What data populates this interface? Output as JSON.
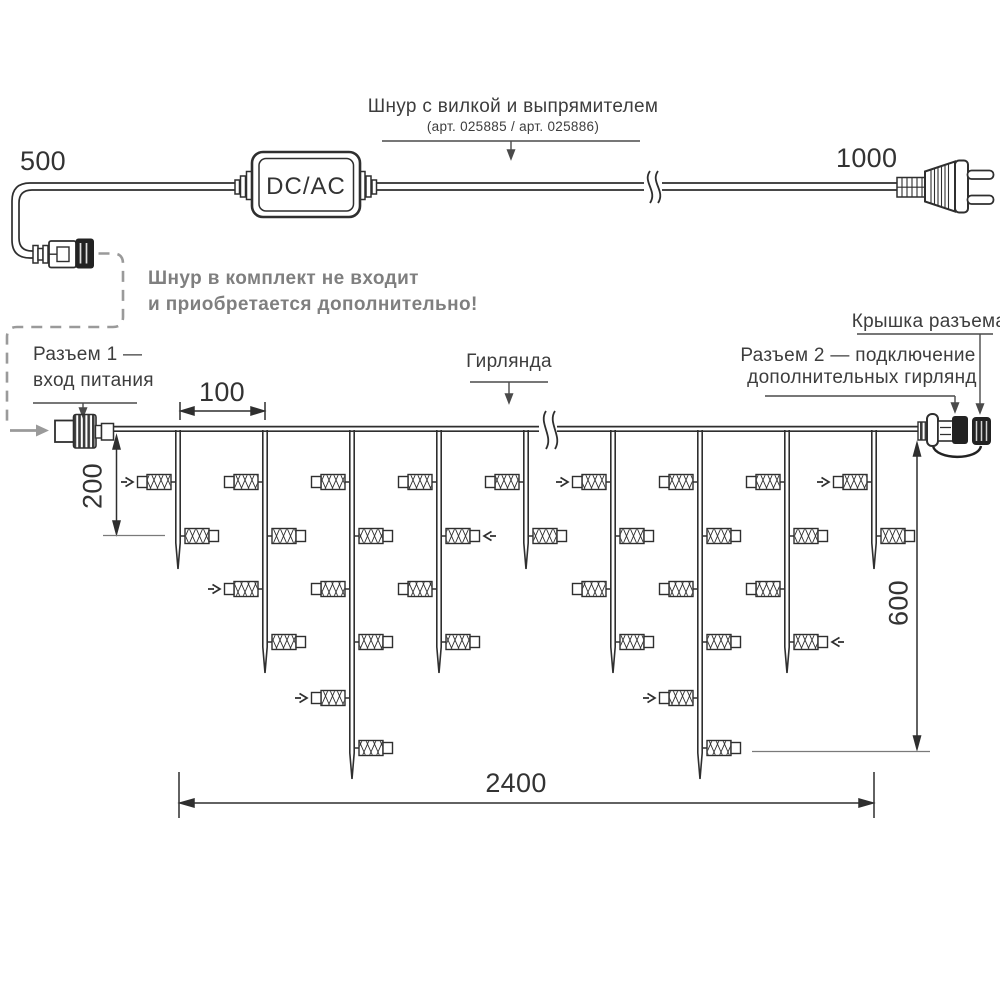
{
  "top_section": {
    "cord_left_length": "500",
    "cord_right_length": "1000",
    "converter_label": "DC/AC",
    "cord_title": "Шнур с вилкой и выпрямителем",
    "cord_subtitle": "(арт. 025885 / арт. 025886)",
    "note_line1": "Шнур в комплект не входит",
    "note_line2": "и приобретается дополнительно!"
  },
  "labels": {
    "connector1_line1": "Разъем 1 —",
    "connector1_line2": "вход питания",
    "garland": "Гирлянда",
    "connector2_line1": "Разъем 2 — подключение",
    "connector2_line2": "дополнительных гирлянд",
    "cap": "Крышка разъема"
  },
  "dimensions": {
    "drop_spacing": "100",
    "first_drop_length": "200",
    "max_drop_length": "600",
    "garland_width": "2400"
  },
  "colors": {
    "ink": "#2f2f2f",
    "leader": "#4a4a4a",
    "tick": "#7a7a7a",
    "dashed": "#9a9a9a",
    "black_part": "#222222",
    "note_gray": "#7f7f7f"
  },
  "garland": {
    "line_x": [
      113.5,
      917.5
    ],
    "lamp_levels": [
      482,
      536,
      589,
      642,
      698,
      748
    ],
    "tip_y": {
      "2": 569,
      "4": 673,
      "6": 779
    },
    "drops": [
      {
        "x": 178,
        "lamps": 2
      },
      {
        "x": 265,
        "lamps": 4
      },
      {
        "x": 352,
        "lamps": 6
      },
      {
        "x": 439,
        "lamps": 4
      },
      {
        "x": 526,
        "lamps": 2
      },
      {
        "x": 613,
        "lamps": 4
      },
      {
        "x": 700,
        "lamps": 6
      },
      {
        "x": 787,
        "lamps": 4
      },
      {
        "x": 874,
        "lamps": 2
      }
    ],
    "arrow_marks": [
      [
        0,
        0
      ],
      [
        1,
        2
      ],
      [
        2,
        4
      ],
      [
        3,
        1
      ],
      [
        5,
        0
      ],
      [
        6,
        4
      ],
      [
        7,
        3
      ],
      [
        8,
        0
      ]
    ]
  }
}
